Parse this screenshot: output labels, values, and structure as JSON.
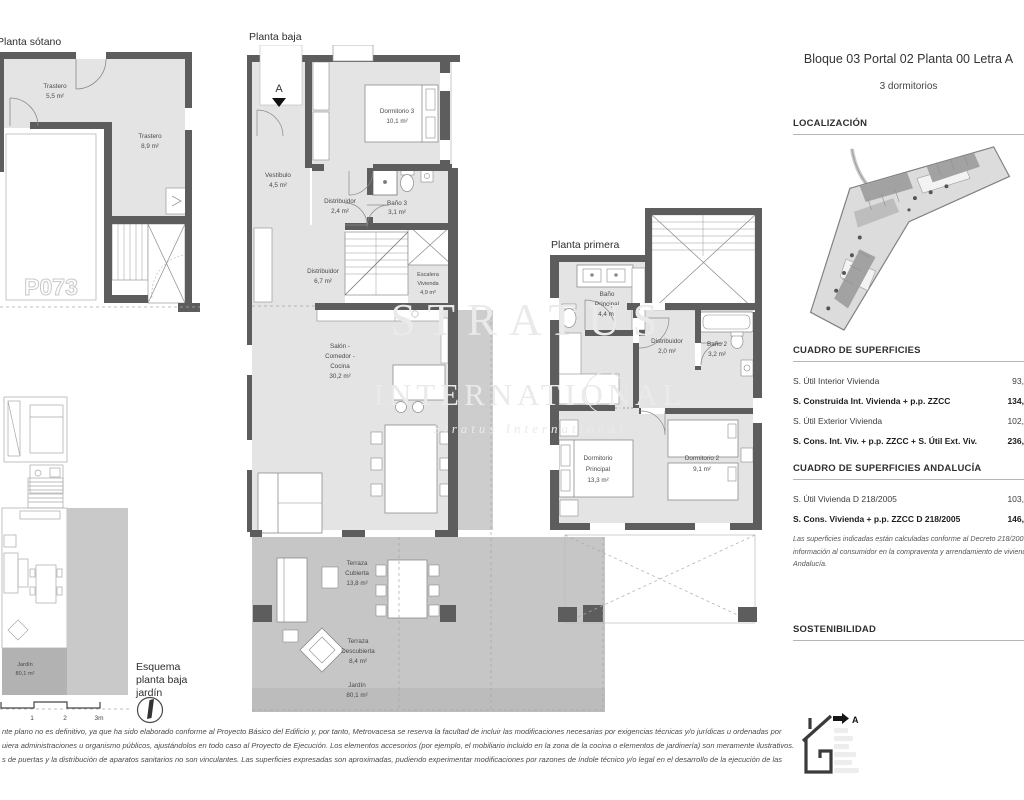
{
  "header": {
    "title": "Bloque 03 Portal 02 Planta 00 Letra A",
    "subtitle": "3 dormitorios"
  },
  "sections": {
    "localizacion": "LOCALIZACIÓN",
    "superficies": "CUADRO DE SUPERFICIES",
    "andalucia": "CUADRO DE SUPERFICIES ANDALUCÍA",
    "sostenibilidad": "SOSTENIBILIDAD"
  },
  "superficies_table": {
    "rows": [
      {
        "label": "S. Útil Interior Vivienda",
        "value": "93,"
      },
      {
        "label": "S. Construida Int. Vivienda + p.p. ZZCC",
        "value": "134,"
      },
      {
        "label": "S. Útil Exterior Vivienda",
        "value": "102,"
      },
      {
        "label": "S. Cons. Int. Viv. + p.p. ZZCC + S. Útil Ext. Viv.",
        "value": "236,"
      }
    ]
  },
  "andalucia_table": {
    "rows": [
      {
        "label": "S. Útil Vivienda D 218/2005",
        "value": "103,"
      },
      {
        "label": "S. Cons. Vivienda + p.p. ZZCC D 218/2005",
        "value": "146,"
      }
    ],
    "note": "Las superficies indicadas están calculadas conforme al Decreto 218/2005 de información al consumidor en la compraventa y arrendamiento de viviendas en Andalucía."
  },
  "energy": {
    "rating": "A"
  },
  "watermark": {
    "l1": "STRATUS",
    "l2": "INTERNATIONAL",
    "l3": "Stratus International"
  },
  "plans": {
    "sotano": {
      "title": "Planta sótano",
      "trastero1": [
        "Trastero",
        "5,5 m²"
      ],
      "trastero2": [
        "Trastero",
        "8,9 m²"
      ],
      "parking": "P073"
    },
    "baja": {
      "title": "Planta baja",
      "marker": "A",
      "vestibulo": [
        "Vestíbulo",
        "4,5 m²"
      ],
      "dormitorio3": [
        "Dormitorio 3",
        "10,1 m²"
      ],
      "distribuidor1": [
        "Distribuidor",
        "2,4 m²"
      ],
      "bano3": [
        "Baño 3",
        "3,1 m²"
      ],
      "distribuidor2": [
        "Distribuidor",
        "6,7 m²"
      ],
      "escalera": [
        "Escalera",
        "Vivienda",
        "4,9 m²"
      ],
      "salon": [
        "Salón -",
        "Comedor -",
        "Cocina",
        "30,2 m²"
      ],
      "terraza_cubierta": [
        "Terraza",
        "Cubierta",
        "13,8 m²"
      ],
      "terraza_descubierta": [
        "Terraza",
        "Descubierta",
        "8,4 m²"
      ],
      "jardin": [
        "Jardín",
        "80,1 m²"
      ]
    },
    "primera": {
      "title": "Planta primera",
      "bano_principal": [
        "Baño",
        "Principal",
        "4,4 m²"
      ],
      "distribuidor": [
        "Distribuidor",
        "2,0 m²"
      ],
      "bano2": [
        "Baño 2",
        "3,2 m²"
      ],
      "dormitorio_principal": [
        "Dormitorio",
        "Principal",
        "13,3 m²"
      ],
      "dormitorio2": [
        "Dormitorio 2",
        "9,1 m²"
      ]
    },
    "esquema": {
      "title": [
        "Esquema",
        "planta baja",
        "jardín"
      ],
      "jardin": [
        "Jardín",
        "80,1 m²"
      ],
      "scale": [
        "1",
        "2",
        "3m"
      ]
    }
  },
  "disclaimer": {
    "line1": "nte plano no es definitivo, ya que ha sido elaborado conforme al Proyecto Básico del Edificio y, por tanto, Metrovacesa se reserva la facultad de incluir las modificaciones necesarias por exigencias técnicas y/o jurídicas u ordenadas por",
    "line2": "uiera administraciones u organismo públicos, ajustándolos en todo caso al Proyecto de Ejecución. Los elementos accesorios (por ejemplo, el mobiliario incluido en la zona de la cocina o elementos de jardinería) son meramente ilustrativos.",
    "line3": "s de puertas y la distribución de aparatos sanitarios no son vinculantes. Las superficies expresadas son aproximadas, pudiendo experimentar modificaciones por razones de índole técnico y/o legal en el desarrollo de la ejecución de las"
  },
  "colors": {
    "wall": "#5d5d5d",
    "floor": "#e4e4e4",
    "terrace": "#c6c6c6",
    "garden": "#bcbcbc",
    "watermark": "#eaeaea"
  }
}
